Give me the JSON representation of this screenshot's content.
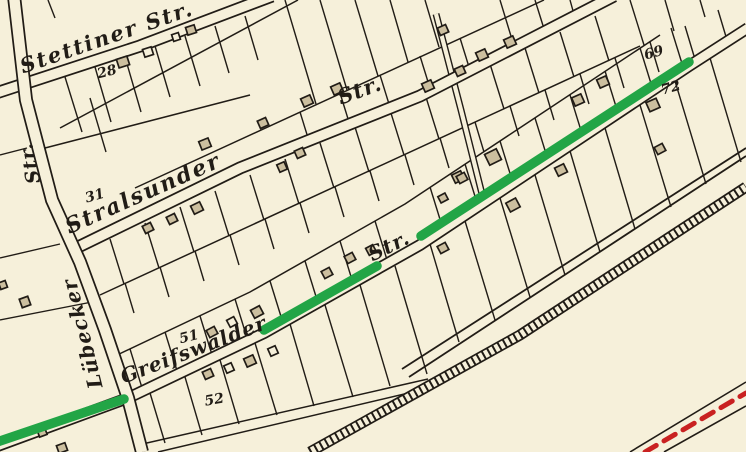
{
  "map": {
    "title": "historic-city-map",
    "colors": {
      "background": "#f6f0da",
      "ink": "#211c16",
      "building_fill": "#ccbf9f",
      "building_white": "#f6f0da",
      "highlight_green": "#22a546",
      "dash_red": "#c92121"
    },
    "street_labels": [
      {
        "id": "stettiner",
        "text": "Stettiner Str.",
        "x": 109,
        "y": 44,
        "rot": -19,
        "size": 21,
        "ls": 2
      },
      {
        "id": "stralsunder",
        "text": "Stralsunder",
        "x": 146,
        "y": 200,
        "rot": -24,
        "size": 22,
        "ls": 2
      },
      {
        "id": "stralsunder-str",
        "text": "Str.",
        "x": 362,
        "y": 97,
        "rot": -20,
        "size": 21,
        "ls": 1
      },
      {
        "id": "greifswalder",
        "text": "Greifswalder",
        "x": 196,
        "y": 356,
        "rot": -21,
        "size": 20,
        "ls": 1
      },
      {
        "id": "greifswalder-str",
        "text": "Str.",
        "x": 392,
        "y": 252,
        "rot": -26,
        "size": 20,
        "ls": 1
      },
      {
        "id": "str-vertical",
        "text": "Str.",
        "x": 36,
        "y": 162,
        "rot": -102,
        "size": 19,
        "ls": 1
      },
      {
        "id": "luebecker",
        "text": "Lübecker",
        "x": 89,
        "y": 332,
        "rot": -104,
        "size": 20,
        "ls": 1
      }
    ],
    "house_numbers": [
      {
        "text": "28",
        "x": 108,
        "y": 76,
        "rot": -14
      },
      {
        "text": "31",
        "x": 96,
        "y": 200,
        "rot": -16
      },
      {
        "text": "51",
        "x": 190,
        "y": 341,
        "rot": -14
      },
      {
        "text": "52",
        "x": 215,
        "y": 404,
        "rot": -10
      },
      {
        "text": "69",
        "x": 655,
        "y": 57,
        "rot": -16
      },
      {
        "text": "72",
        "x": 672,
        "y": 92,
        "rot": -16
      }
    ],
    "streets": [
      {
        "id": "lane-diagonal",
        "pts": [
          [
            436,
            14
          ],
          [
            461,
            110
          ],
          [
            483,
            198
          ]
        ],
        "outer": 7,
        "inner": 4.2
      },
      {
        "id": "stettiner-str",
        "pts": [
          [
            -4,
            93
          ],
          [
            140,
            46
          ],
          [
            272,
            -4
          ]
        ],
        "outer": 13,
        "inner": 9.5
      },
      {
        "id": "stralsunder-str",
        "pts": [
          [
            72,
            250
          ],
          [
            240,
            168
          ],
          [
            420,
            96
          ],
          [
            614,
            -4
          ]
        ],
        "outer": 13,
        "inner": 9.5
      },
      {
        "id": "greifswalder-str",
        "pts": [
          [
            -8,
            448
          ],
          [
            128,
            398
          ],
          [
            264,
            333
          ],
          [
            420,
            245
          ],
          [
            689,
            66
          ],
          [
            748,
            28
          ]
        ],
        "outer": 12,
        "inner": 8.6
      },
      {
        "id": "luebecker-str",
        "pts": [
          [
            14,
            -4
          ],
          [
            26,
            100
          ],
          [
            52,
            200
          ],
          [
            80,
            262
          ],
          [
            105,
            330
          ],
          [
            128,
            398
          ],
          [
            142,
            452
          ]
        ],
        "outer": 14,
        "inner": 10.5
      }
    ],
    "back_lines": [
      [
        [
          135,
          188
        ],
        [
          544,
          0
        ]
      ],
      [
        [
          60,
          128
        ],
        [
          298,
          0
        ]
      ],
      [
        [
          45,
          148
        ],
        [
          250,
          95
        ]
      ],
      [
        [
          100,
          295
        ],
        [
          640,
          46
        ]
      ],
      [
        [
          115,
          356
        ],
        [
          250,
          292
        ],
        [
          405,
          204
        ],
        [
          660,
          35
        ]
      ],
      [
        [
          138,
          445
        ],
        [
          428,
          379
        ]
      ],
      [
        [
          158,
          452
        ],
        [
          434,
          387
        ]
      ]
    ],
    "lot_lines": [
      [
        65,
        77,
        82,
        132
      ],
      [
        95,
        67,
        111,
        122
      ],
      [
        125,
        57,
        141,
        112
      ],
      [
        155,
        46,
        170,
        97
      ],
      [
        185,
        36,
        200,
        86
      ],
      [
        215,
        26,
        229,
        73
      ],
      [
        245,
        16,
        258,
        60
      ],
      [
        285,
        0,
        316,
        104
      ],
      [
        320,
        0,
        347,
        90
      ],
      [
        355,
        0,
        378,
        76
      ],
      [
        390,
        0,
        408,
        62
      ],
      [
        425,
        0,
        439,
        47
      ],
      [
        500,
        0,
        514,
        46
      ],
      [
        535,
        0,
        545,
        32
      ],
      [
        570,
        0,
        575,
        18
      ],
      [
        300,
        112,
        309,
        141
      ],
      [
        340,
        93,
        349,
        122
      ],
      [
        380,
        75,
        389,
        104
      ],
      [
        420,
        56,
        429,
        85
      ],
      [
        460,
        38,
        469,
        67
      ],
      [
        90,
        98,
        106,
        152
      ],
      [
        110,
        239,
        124,
        284
      ],
      [
        145,
        223,
        159,
        268
      ],
      [
        180,
        207,
        194,
        252
      ],
      [
        215,
        191,
        229,
        236
      ],
      [
        250,
        175,
        264,
        220
      ],
      [
        285,
        159,
        299,
        204
      ],
      [
        320,
        143,
        334,
        188
      ],
      [
        355,
        127,
        369,
        172
      ],
      [
        390,
        110,
        404,
        155
      ],
      [
        425,
        94,
        439,
        139
      ],
      [
        490,
        64,
        504,
        109
      ],
      [
        525,
        48,
        539,
        93
      ],
      [
        560,
        32,
        574,
        77
      ],
      [
        595,
        16,
        609,
        61
      ],
      [
        630,
        0,
        644,
        45
      ],
      [
        665,
        0,
        674,
        31
      ],
      [
        700,
        0,
        705,
        17
      ],
      [
        125,
        283,
        134,
        313
      ],
      [
        160,
        267,
        169,
        297
      ],
      [
        195,
        251,
        204,
        281
      ],
      [
        230,
        235,
        239,
        265
      ],
      [
        265,
        219,
        274,
        249
      ],
      [
        300,
        203,
        309,
        233
      ],
      [
        335,
        187,
        344,
        217
      ],
      [
        370,
        171,
        379,
        201
      ],
      [
        405,
        155,
        414,
        185
      ],
      [
        440,
        138,
        449,
        168
      ],
      [
        475,
        122,
        484,
        152
      ],
      [
        510,
        106,
        519,
        136
      ],
      [
        545,
        90,
        554,
        120
      ],
      [
        580,
        74,
        589,
        104
      ],
      [
        615,
        58,
        624,
        88
      ],
      [
        650,
        42,
        659,
        72
      ],
      [
        685,
        26,
        694,
        56
      ],
      [
        718,
        10,
        727,
        40
      ],
      [
        130,
        349,
        143,
        391
      ],
      [
        165,
        332,
        178,
        374
      ],
      [
        200,
        316,
        213,
        358
      ],
      [
        235,
        299,
        248,
        341
      ],
      [
        270,
        281,
        283,
        323
      ],
      [
        305,
        261,
        318,
        303
      ],
      [
        340,
        241,
        353,
        283
      ],
      [
        375,
        221,
        388,
        263
      ],
      [
        430,
        187,
        443,
        229
      ],
      [
        465,
        164,
        478,
        206
      ],
      [
        500,
        141,
        513,
        183
      ],
      [
        535,
        118,
        548,
        160
      ],
      [
        570,
        95,
        583,
        137
      ],
      [
        605,
        71,
        618,
        113
      ],
      [
        640,
        48,
        653,
        90
      ],
      [
        671,
        28,
        684,
        70
      ],
      [
        150,
        393,
        165,
        443
      ],
      [
        185,
        377,
        202,
        435
      ],
      [
        220,
        360,
        239,
        424
      ],
      [
        255,
        343,
        277,
        415
      ],
      [
        290,
        324,
        314,
        406
      ],
      [
        325,
        305,
        353,
        397
      ],
      [
        360,
        285,
        390,
        386
      ],
      [
        395,
        266,
        427,
        374
      ],
      [
        430,
        244,
        459,
        342
      ],
      [
        465,
        221,
        495,
        320
      ],
      [
        500,
        198,
        530,
        297
      ],
      [
        535,
        175,
        565,
        275
      ],
      [
        570,
        151,
        600,
        252
      ],
      [
        605,
        128,
        635,
        229
      ],
      [
        640,
        105,
        671,
        207
      ],
      [
        675,
        81,
        706,
        184
      ],
      [
        710,
        58,
        741,
        162
      ],
      [
        0,
        155,
        27,
        148
      ],
      [
        0,
        258,
        60,
        244
      ],
      [
        0,
        320,
        92,
        302
      ],
      [
        48,
        0,
        55,
        18
      ]
    ],
    "road_pair": [
      [
        402,
        369,
        746,
        148
      ],
      [
        409,
        377,
        746,
        156
      ]
    ],
    "railway": {
      "pts": [
        [
          310,
          452
        ],
        [
          520,
          335
        ],
        [
          746,
          187
        ]
      ],
      "band": 11,
      "gap": 7.6,
      "tie_width": 9,
      "tie_dash": "2 4"
    },
    "red_road": {
      "lines": [
        [
          630,
          452,
          746,
          382
        ],
        [
          664,
          452,
          746,
          406
        ]
      ],
      "dash": [
        645,
        452,
        746,
        393
      ],
      "dash_width": 5,
      "dash_pattern": "13 9"
    },
    "green_segments": [
      [
        -6,
        443,
        124,
        399
      ],
      [
        264,
        330,
        377,
        266
      ],
      [
        421,
        236,
        689,
        62
      ]
    ],
    "green_width": 9.5,
    "buildings": [
      [
        123,
        62,
        11,
        9,
        -18,
        "t"
      ],
      [
        148,
        52,
        9,
        8,
        -18,
        "w"
      ],
      [
        176,
        37,
        7,
        7,
        -18,
        "w"
      ],
      [
        191,
        30,
        9,
        8,
        -18,
        "t"
      ],
      [
        205,
        144,
        10,
        9,
        -22,
        "t"
      ],
      [
        263,
        123,
        9,
        8,
        -24,
        "t"
      ],
      [
        307,
        101,
        10,
        9,
        -24,
        "t"
      ],
      [
        337,
        89,
        10,
        9,
        -24,
        "t"
      ],
      [
        300,
        153,
        9,
        8,
        -24,
        "t"
      ],
      [
        282,
        167,
        8,
        8,
        -24,
        "t"
      ],
      [
        428,
        86,
        10,
        9,
        -24,
        "t"
      ],
      [
        460,
        71,
        9,
        8,
        -24,
        "t"
      ],
      [
        443,
        30,
        9,
        8,
        -24,
        "t"
      ],
      [
        482,
        55,
        10,
        9,
        -24,
        "t"
      ],
      [
        510,
        42,
        10,
        9,
        -24,
        "t"
      ],
      [
        578,
        100,
        10,
        9,
        -24,
        "t"
      ],
      [
        603,
        82,
        10,
        9,
        -24,
        "t"
      ],
      [
        653,
        105,
        11,
        10,
        -24,
        "t"
      ],
      [
        660,
        149,
        9,
        8,
        -28,
        "t"
      ],
      [
        493,
        157,
        13,
        12,
        -26,
        "t"
      ],
      [
        458,
        177,
        10,
        9,
        -26,
        "t"
      ],
      [
        561,
        170,
        10,
        9,
        -26,
        "t"
      ],
      [
        148,
        228,
        9,
        8,
        -26,
        "t"
      ],
      [
        172,
        219,
        9,
        8,
        -26,
        "t"
      ],
      [
        197,
        208,
        10,
        9,
        -26,
        "t"
      ],
      [
        212,
        332,
        9,
        8,
        -28,
        "t"
      ],
      [
        232,
        322,
        8,
        8,
        -28,
        "w"
      ],
      [
        257,
        312,
        10,
        9,
        -28,
        "t"
      ],
      [
        327,
        273,
        9,
        8,
        -28,
        "t"
      ],
      [
        350,
        258,
        9,
        8,
        -28,
        "t"
      ],
      [
        371,
        250,
        8,
        8,
        -28,
        "t"
      ],
      [
        443,
        198,
        8,
        7,
        -28,
        "t"
      ],
      [
        462,
        178,
        9,
        8,
        -28,
        "t"
      ],
      [
        513,
        205,
        11,
        10,
        -28,
        "t"
      ],
      [
        443,
        248,
        9,
        8,
        -28,
        "t"
      ],
      [
        208,
        374,
        9,
        8,
        -24,
        "t"
      ],
      [
        229,
        368,
        8,
        8,
        -24,
        "w"
      ],
      [
        250,
        361,
        10,
        9,
        -24,
        "t"
      ],
      [
        273,
        351,
        8,
        8,
        -24,
        "w"
      ],
      [
        3,
        285,
        7,
        7,
        -20,
        "t"
      ],
      [
        25,
        302,
        9,
        9,
        -20,
        "t"
      ],
      [
        42,
        432,
        8,
        8,
        -20,
        "t"
      ],
      [
        62,
        448,
        9,
        8,
        -20,
        "t"
      ]
    ]
  }
}
